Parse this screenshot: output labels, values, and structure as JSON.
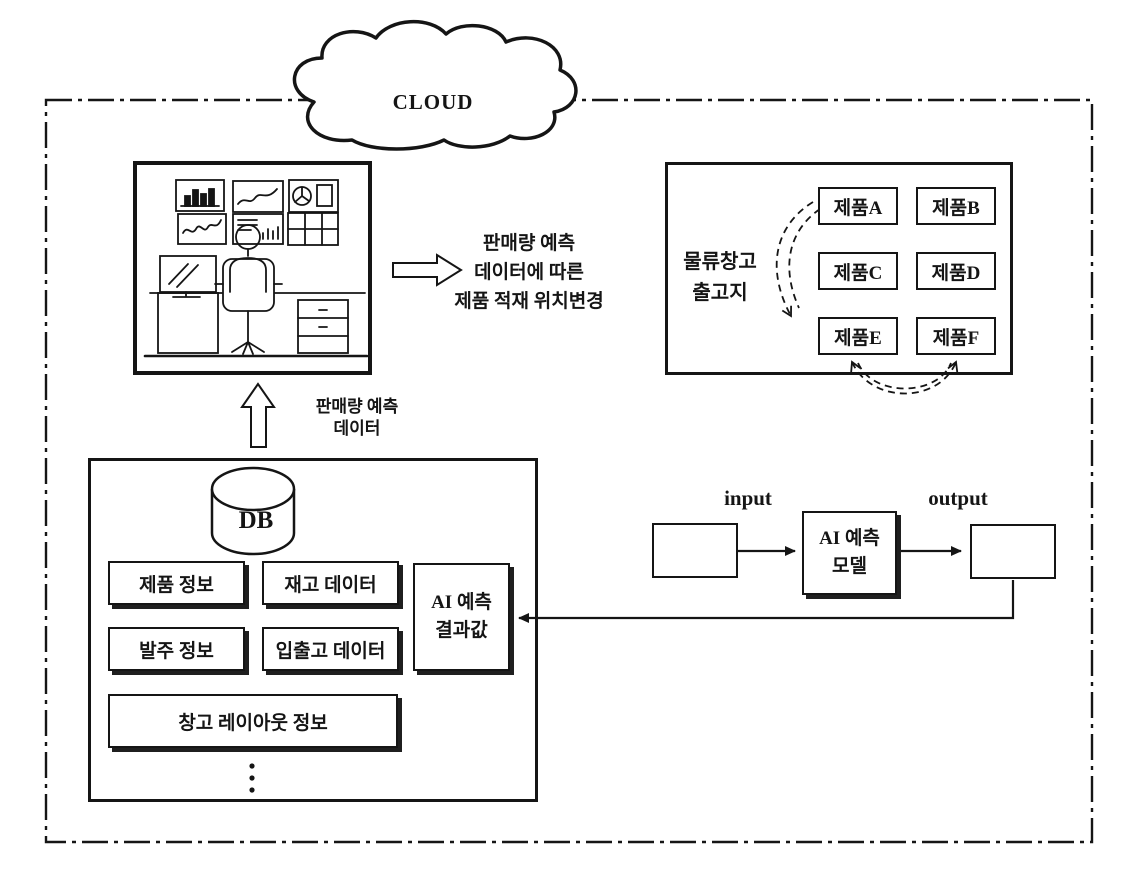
{
  "colors": {
    "ink": "#151515",
    "paper": "#ffffff"
  },
  "cloud": {
    "label": "CLOUD"
  },
  "monitoring": {
    "note_lines": [
      "판매량 예측",
      "데이터에 따른",
      "제품 적재 위치변경"
    ]
  },
  "sales_feed": {
    "lines": [
      "판매량 예측",
      "데이터"
    ]
  },
  "warehouse": {
    "label_lines": [
      "물류창고",
      "출고지"
    ],
    "products": [
      "제품A",
      "제품B",
      "제품C",
      "제품D",
      "제품E",
      "제품F"
    ]
  },
  "database": {
    "label": "DB",
    "items": [
      "제품 정보",
      "재고 데이터",
      "발주 정보",
      "입출고 데이터",
      "창고 레이아웃 정보"
    ]
  },
  "ai": {
    "result_lines": [
      "AI 예측",
      "결과값"
    ],
    "model_lines": [
      "AI 예측",
      "모델"
    ],
    "input_label": "input",
    "output_label": "output"
  },
  "icons": [
    "cloud-shape",
    "operator-workstation-icon",
    "database-cylinder-icon",
    "up-block-arrow-icon",
    "right-block-arrow-icon",
    "curved-dashed-arrow-icon",
    "swap-dashed-arrow-icon",
    "vertical-ellipsis-icon"
  ]
}
